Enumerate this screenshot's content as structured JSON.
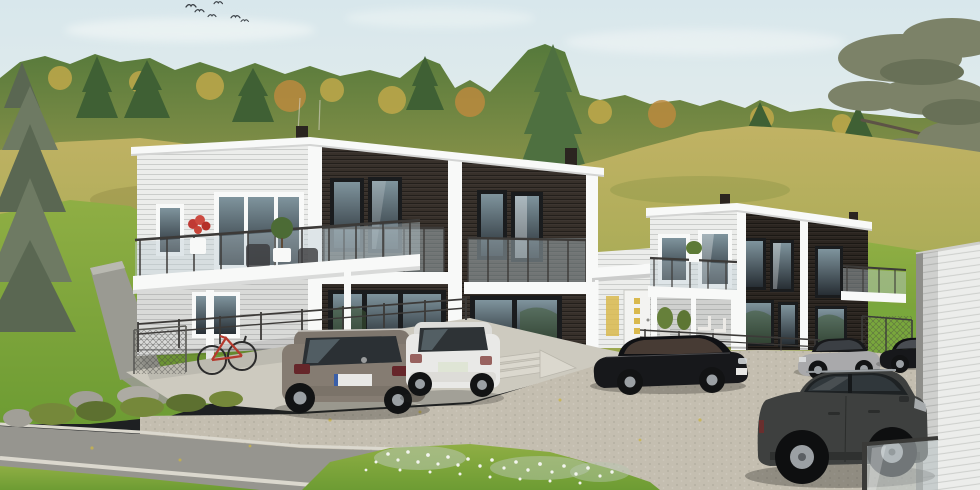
{
  "colors": {
    "sky_top": "#d8e7ec",
    "sky_mid": "#e4edec",
    "sky_horizon": "#eef1e7",
    "cloud": "#f6f9f8",
    "bird": "#3a4046",
    "forest_top": "#55793b",
    "forest_bottom": "#97994d",
    "conifer": "#3f6034",
    "conifer_light": "#4e7040",
    "autumn_yellow": "#bfa84a",
    "autumn_orange": "#bb8a3e",
    "spruce_grey": "#6e7a63",
    "spruce_grey_dark": "#5a6752",
    "pine_foliage": "#7c8268",
    "pine_foliage_dark": "#687057",
    "pine_branch": "#5d5346",
    "meadow_top": "#c1b264",
    "meadow_bottom": "#9aa84e",
    "lawn_top": "#8fae44",
    "lawn_bottom": "#6d9c33",
    "grass_bright": "#79a73c",
    "bush_green": "#75883a",
    "bush_dark": "#5d7030",
    "rock_grey": "#a19f97",
    "siding_white": "#ecedeb",
    "siding_shadow": "#d7d8d5",
    "fascia": "#f8f9f8",
    "dark_wood": "#37302a",
    "dark_wood_deep": "#2b2520",
    "window_frame": "#1a1c1e",
    "window_glass_top": "#7f949d",
    "window_glass_bottom": "#272e34",
    "balcony_glass": "#b9cad1",
    "rail_dark": "#3c3a38",
    "door_white": "#f3f3f1",
    "door_glow": "#d9b94e",
    "concrete": "#cdcabf",
    "cobble": "#c4beb0",
    "asphalt": "#96958f",
    "curb": "#dbd8ce",
    "wall_grey": "#9a9a92",
    "car_grey": "#857c72",
    "car_white": "#e9e9e7",
    "car_black": "#17181b",
    "car_silver": "#a9a9ab",
    "car_suv_dark": "#3e403f",
    "wheel_dark": "#121314",
    "rim_silver": "#9ba0a4",
    "taillight_red": "#66262a",
    "plate_white": "#e8e8e6",
    "bike_red": "#b53a2e",
    "flower_white": "#f3f5ef",
    "leaf_yellow": "#c9b44a",
    "shadow": "#23231e"
  },
  "scene": {
    "sky": {
      "birds": 6,
      "clouds": 3
    },
    "background": {
      "forest": "mixed autumn forest band",
      "hill": "grassy meadow hillside",
      "left_tree": "grey spruce",
      "right_tree": "pine branches"
    },
    "buildings": [
      {
        "id": "left-duplex",
        "floors": 2,
        "style": "flat roof, white and dark stained wood siding",
        "features": [
          "glass balcony",
          "juliet balconies",
          "support posts",
          "chimneys",
          "potted plants"
        ]
      },
      {
        "id": "right-duplex",
        "floors": 2,
        "style": "flat roof, white and dark stained wood siding",
        "features": [
          "glass balcony",
          "covered terrace",
          "corner balcony",
          "chimneys"
        ]
      }
    ],
    "entrance": {
      "door": "white front door with four glazed squares",
      "canopy": "white canopy on posts",
      "sidelight": "lit sidelight window"
    },
    "vehicles": [
      {
        "id": "grey-suv-rear",
        "color_key": "car_grey"
      },
      {
        "id": "white-suv-rear",
        "color_key": "car_white"
      },
      {
        "id": "black-sedan",
        "color_key": "car_black"
      },
      {
        "id": "silver-sedan",
        "color_key": "car_silver"
      },
      {
        "id": "black-coupe-partial",
        "color_key": "car_black"
      },
      {
        "id": "dark-suv-foreground",
        "color_key": "car_suv_dark"
      }
    ],
    "foreground": [
      "concrete terrace",
      "steel railing",
      "chain-link fence",
      "red bicycle",
      "juniper bushes",
      "boulders",
      "cobblestone parking",
      "asphalt road",
      "concrete curbs",
      "grass with white flowers",
      "white fence wall",
      "glass panel",
      "entrance steps"
    ]
  }
}
